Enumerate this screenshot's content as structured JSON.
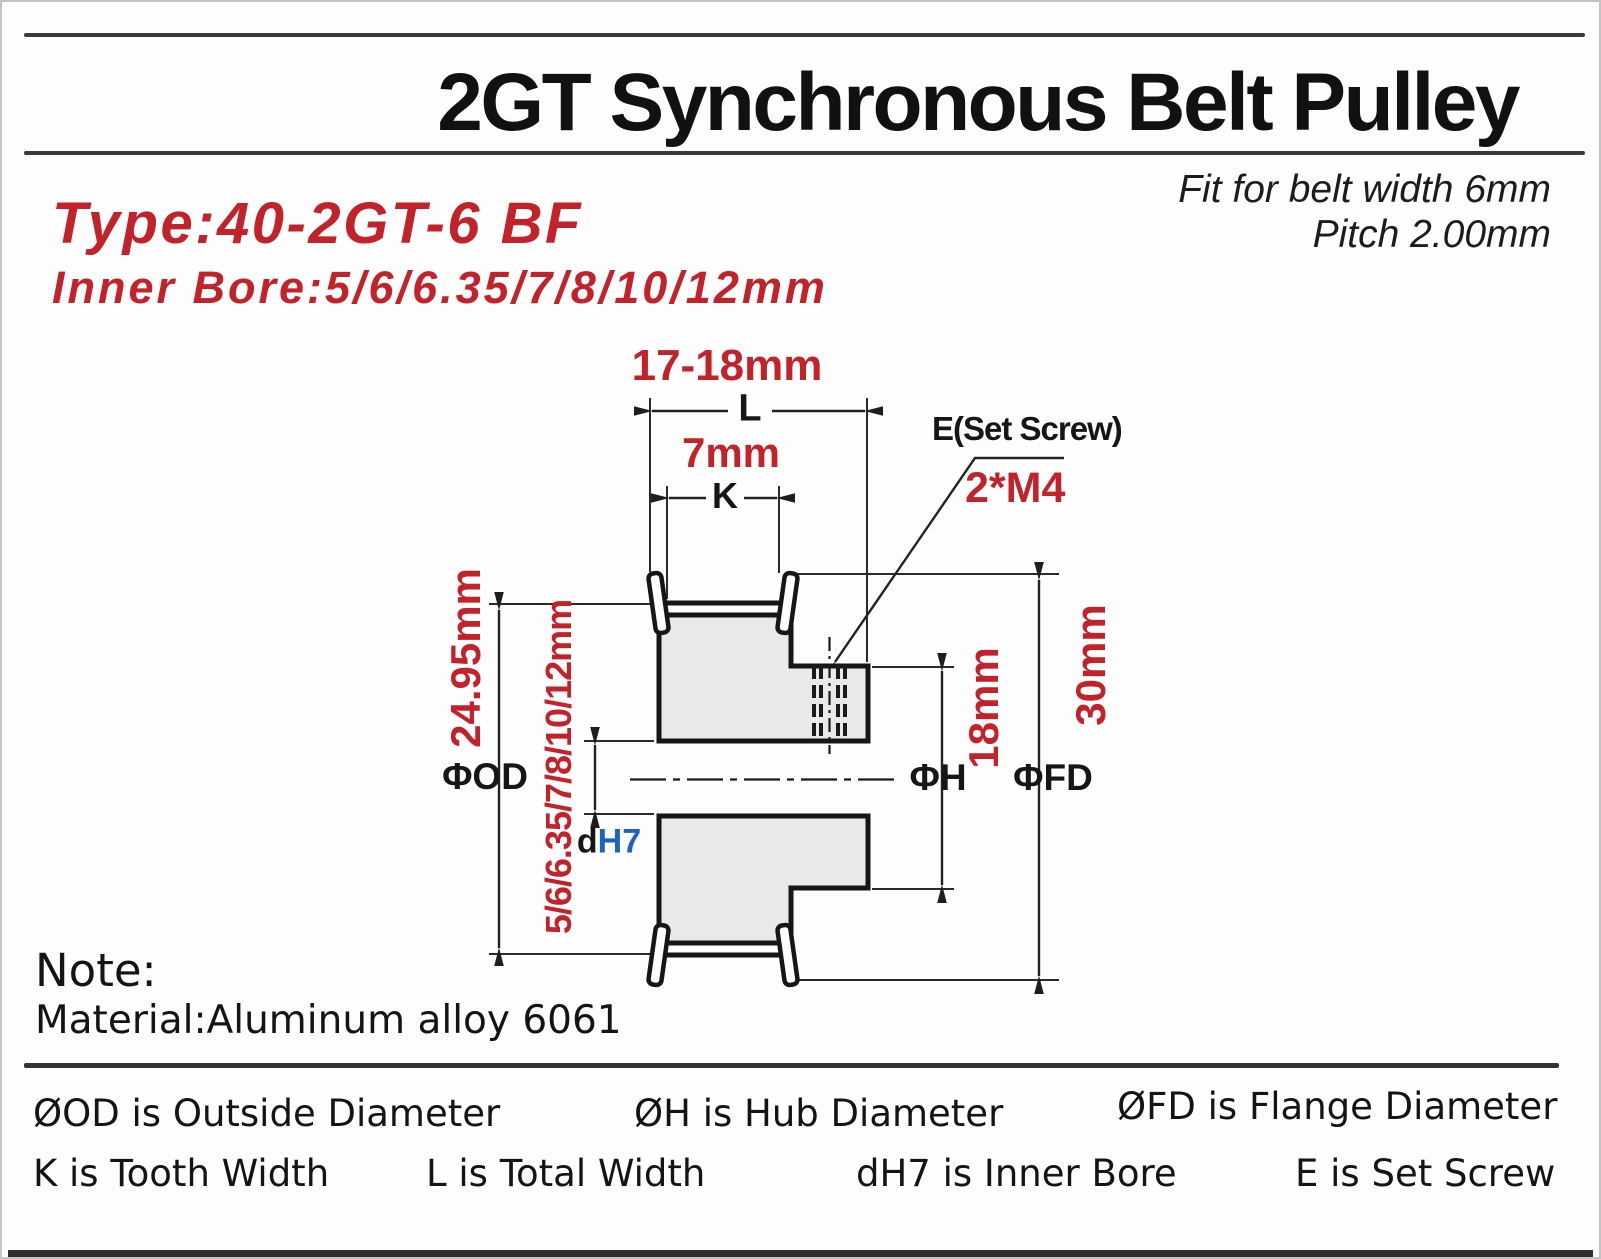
{
  "header": {
    "title": "2GT Synchronous Belt Pulley",
    "fit_note_line1": "Fit for belt width 6mm",
    "fit_note_line2": "Pitch 2.00mm",
    "type_line": "Type:40-2GT-6 BF",
    "inner_bore_line": "Inner Bore:5/6/6.35/7/8/10/12mm"
  },
  "drawing": {
    "total_width_value": "17-18mm",
    "total_width_symbol": "L",
    "tooth_width_value": "7mm",
    "tooth_width_symbol": "K",
    "set_screw_label": "E(Set Screw)",
    "set_screw_spec": "2*M4",
    "outside_diameter_value": "24.95mm",
    "outside_diameter_symbol": "ΦOD",
    "inner_bore_value": "5/6/6.35/7/8/10/12mm",
    "inner_bore_symbol_d": "d",
    "inner_bore_symbol_h7": "H7",
    "hub_diameter_value": "18mm",
    "hub_diameter_symbol": "ΦH",
    "flange_diameter_value": "30mm",
    "flange_diameter_symbol": "ΦFD"
  },
  "note": {
    "heading": "Note:",
    "material": "Material:Aluminum alloy 6061"
  },
  "legend": {
    "row1": [
      {
        "text": "ØOD is Outside Diameter"
      },
      {
        "text": "ØH is Hub Diameter"
      },
      {
        "text": "ØFD is Flange Diameter"
      }
    ],
    "row2": [
      {
        "text": "K is Tooth Width"
      },
      {
        "text": "L is Total Width"
      },
      {
        "text": "dH7 is Inner Bore"
      },
      {
        "text": "E is Set Screw"
      }
    ]
  },
  "colors": {
    "accent_red": "#c3222a",
    "accent_blue": "#1b62c3",
    "body_fill": "#e9e9e9",
    "rule_dark": "#3a3a3a"
  }
}
